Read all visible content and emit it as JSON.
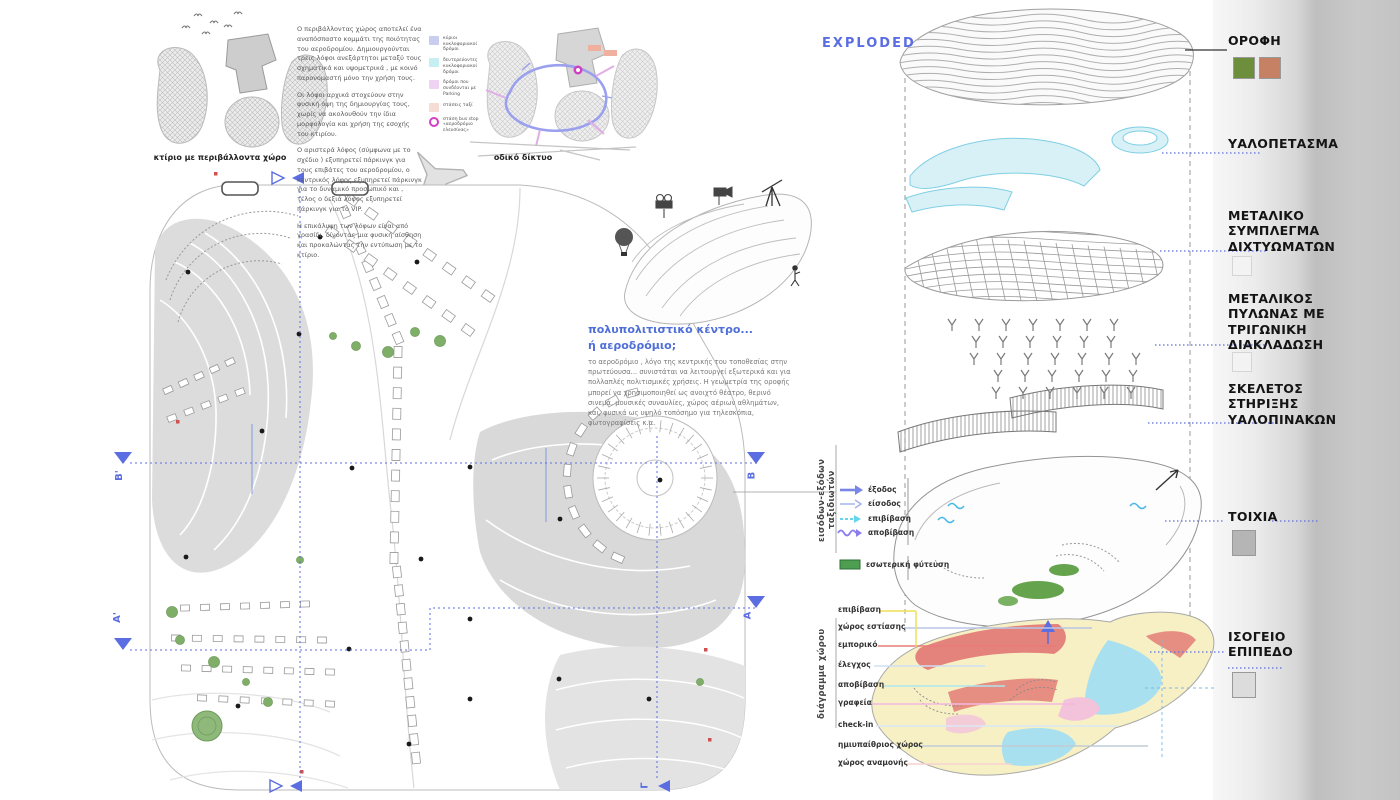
{
  "colors": {
    "accent_blue": "#5b6ee1",
    "title_blue": "#4f6fd8",
    "roof_grass": "#6d8f3c",
    "roof_brick": "#c68164",
    "concrete": "#b5b5b5",
    "concrete_light": "#dcdcdc"
  },
  "site": {
    "caption_left": "κτίριο με περιβάλλοντα χώρο",
    "caption_right": "οδικό δίκτυο",
    "paragraphs": [
      "Ο περιβάλλοντας χώρος αποτελεί ένα αναπόσπαστο κομμάτι της ποιότητας του αεροδρομίου. Δημιουργούνται τρεις λόφοι ανεξάρτητοι μεταξύ τους σχηματικά και υψομετρικά , με κοινό παρονομαστή μόνο την χρήση τους.",
      "Οι λόφοι αρχικά στοχεύουν στην φυσική όψη της δημιουργίας τους, χωρίς να ακολουθούν την ίδια μορφολογία και χρήση της εσοχής του κτιρίου.",
      "Ο αριστερά λόφος (σύμφωνα με το σχέδιο ) εξυπηρετεί πάρκινγκ για τους επιβάτες του αεροδρομίου, ο κεντρικός λόφος εξυπηρετεί πάρκινγκ για το δυναμικό προσωπικό και , τέλος ο δεξιά λόφος εξυπηρετεί πάρκινγκ για το VIP.",
      "Η επικάλυψη των λόφων είναι από γρασίδι, δίνοντας μια φυσική αίσθηση και προκαλώντας την εντύπωση με το κτίριο."
    ],
    "road_legend": [
      {
        "label": "κύριοι κυκλοφοριακοί δρόμοι",
        "color": "#c9cdf0"
      },
      {
        "label": "δευτερεύοντες κυκλοφοριακοί δρόμοι",
        "color": "#c6eff2"
      },
      {
        "label": "δρόμοι που συνδέονται με Parking",
        "color": "#eed4f2"
      },
      {
        "label": "στάσεις ταξί",
        "color": "#f6dcd4"
      },
      {
        "label": "στάση bus stop «αεροδρόμιο ελευσίνας»",
        "color": "#d23fc3"
      }
    ]
  },
  "center_text": {
    "title_line1": "πολυπολιτιστικό κέντρο...",
    "title_line2": "ή αεροδρόμιο;",
    "body": "το αεροδρόμιο , λόγο της κεντρικής του τοποθεσίας στην πρωτεύουσα... συνιστάται να λειτουργεί εξωτερικά και για πολλαπλές πολιτισμικές χρήσεις. Η γεωμετρία της οροφής μπορεί να χρησιμοποιηθεί ως ανοιχτό θέατρο, θερινό σινεμά, μουσικές συναυλίες, χώρος αέριων αθλημάτων, και, φυσικά ως υψηλό τοπόσημο για τηλεσκόπια, φωτογραφίσεις κ.α."
  },
  "exploded": {
    "title": "EXPLODED",
    "labels": [
      {
        "text": "ΟΡΟΦΗ"
      },
      {
        "text": "ΥΑΛΟΠΕΤΑΣΜΑ"
      },
      {
        "text": "ΜΕΤΑΛΙΚΟ\nΣΥΜΠΛΕΓΜΑ\nΔΙΧΤΥΩΜΑΤΩΝ"
      },
      {
        "text": "ΜΕΤΑΛΙΚΟΣ\nΠΥΛΩΝΑΣ ΜΕ\nΤΡΙΓΩΝΙΚΗ\nΔΙΑΚΛΑΔΩΣΗ"
      },
      {
        "text": "ΣΚΕΛΕΤΟΣ\nΣΤΗΡΙΞΗΣ\nΥΑΛΟΠΙΝΑΚΩΝ"
      },
      {
        "text": "ΤΟΙΧΙΑ"
      },
      {
        "text": "ΙΣΟΓΕΙΟ\nΕΠΙΠΕΔΟ"
      }
    ]
  },
  "flow_legend": [
    {
      "label": "έξοδος",
      "color": "#7a85e8"
    },
    {
      "label": "είσοδος",
      "color": "#aab2f0"
    },
    {
      "label": "επιβίβαση",
      "color": "#66d4ea"
    },
    {
      "label": "αποβίβαση",
      "color": "#8a7cf0"
    },
    {
      "label": "εσωτερική φύτευση",
      "color": "#4e9e52"
    }
  ],
  "ground_legend": [
    {
      "label": "επιβίβαση",
      "color": "#f0df52"
    },
    {
      "label": "χώρος εστίασης",
      "color": "#b9c6e8"
    },
    {
      "label": "εμπορικό",
      "color": "#e87a7a"
    },
    {
      "label": "έλεγχος",
      "color": "#cfe0f5"
    },
    {
      "label": "αποβίβαση",
      "color": "#aee6f0"
    },
    {
      "label": "γραφεία",
      "color": "#f3b8dd"
    },
    {
      "label": "check-in",
      "color": "#dce8f5"
    },
    {
      "label": "ημιυπαίθριος χώρος",
      "color": "#c0ccd6"
    },
    {
      "label": "χώρος αναμονής",
      "color": "#f5d2d2"
    }
  ],
  "vertical_labels": {
    "top": "εισόδων-εξόδων ταξιδιωτών",
    "bottom": "διάγραμμα χώρου"
  },
  "sections": {
    "b_left": "Β'",
    "b_right": "Β",
    "a_left": "Α'",
    "a_right": "Α",
    "gamma": "Γ"
  }
}
